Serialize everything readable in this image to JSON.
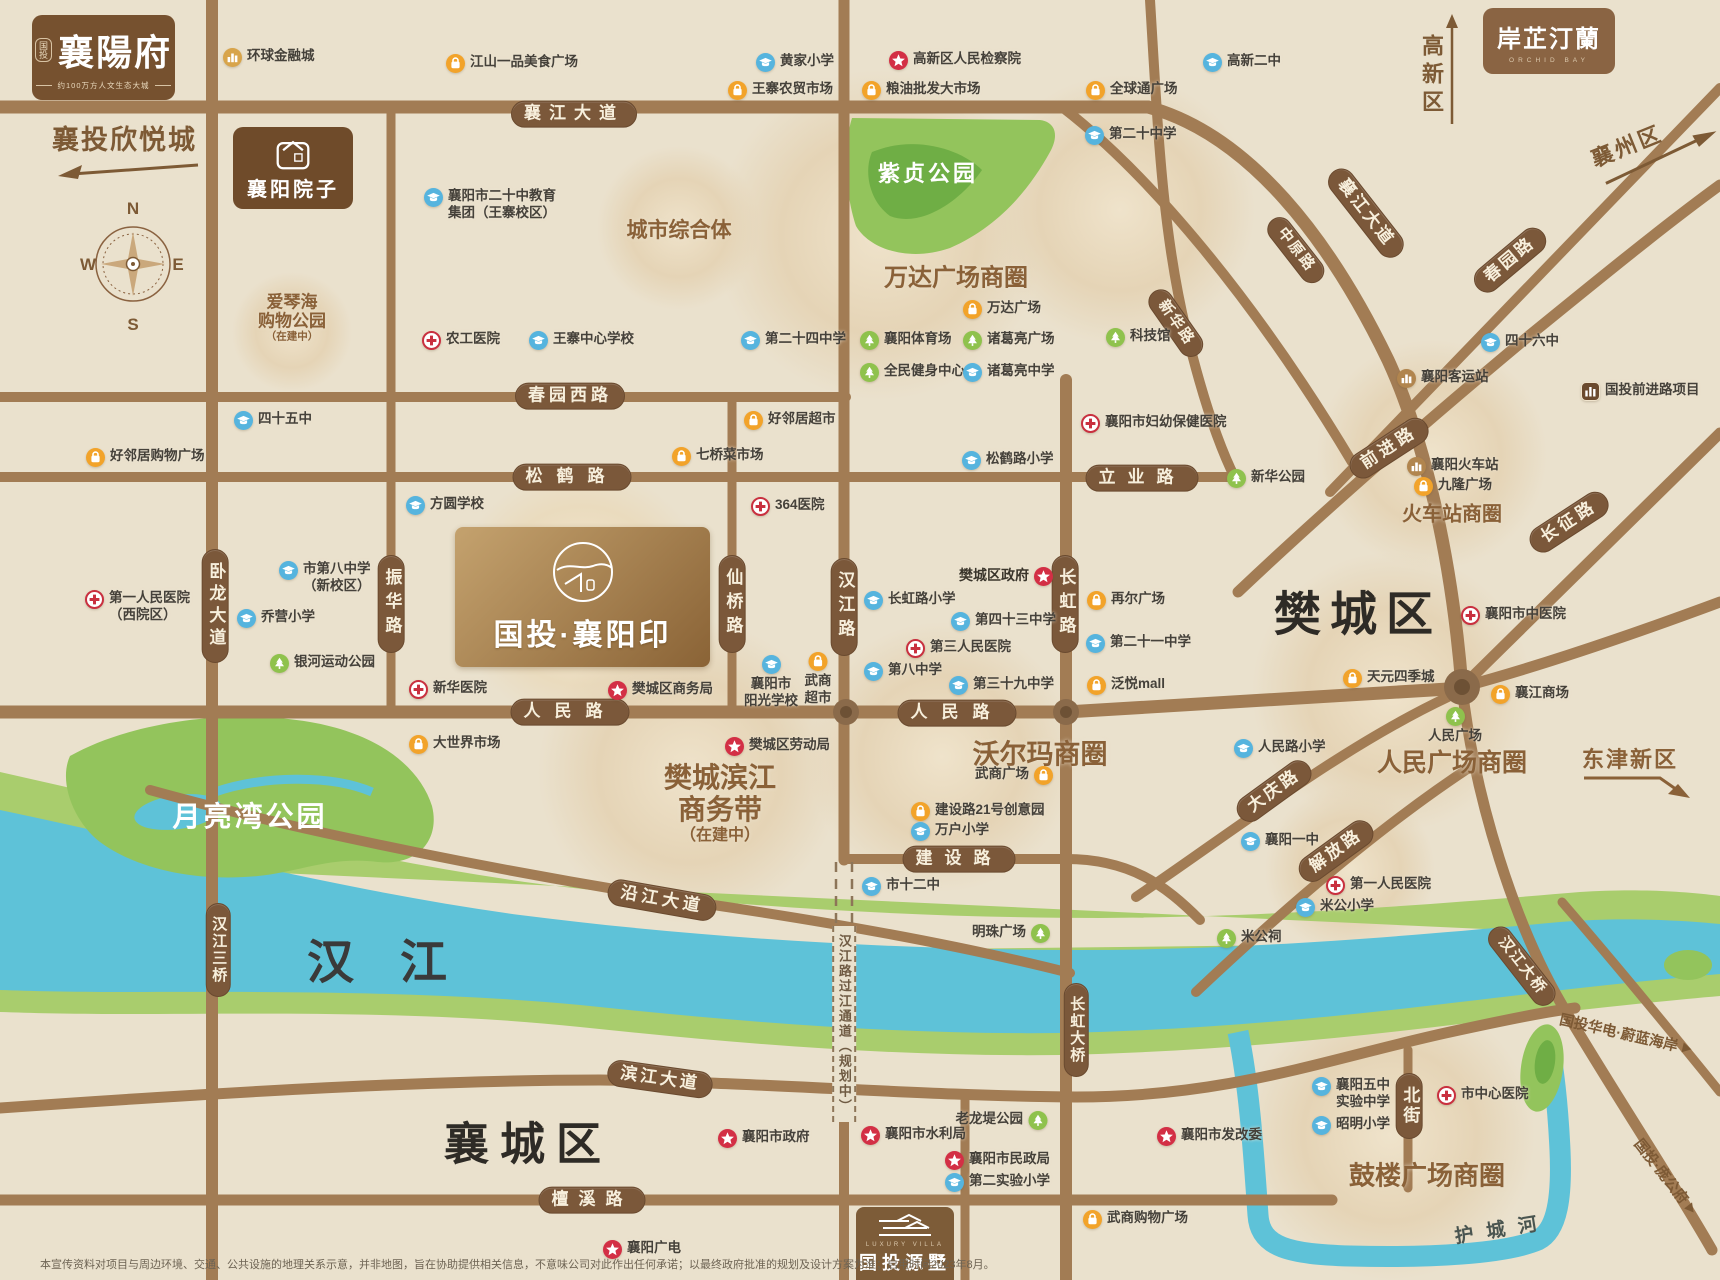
{
  "title": "国投·襄阳印 区位示意图",
  "colors": {
    "background": "#eae1cd",
    "road": "#a27c54",
    "pill": "#7b583a",
    "river": "#5ec2d8",
    "bank_green": "#a9cd6d",
    "park_green": "#93c45c",
    "accent_brown": "#8a6138",
    "school_blue": "#56b4de",
    "hospital_red": "#c9303f",
    "gov_red": "#d32f45",
    "shop_orange": "#f2a32a",
    "park_icon_green": "#8fc24d",
    "station_brown": "#b1854e"
  },
  "compass": {
    "n": "N",
    "e": "E",
    "s": "S",
    "w": "W"
  },
  "logos": {
    "xiangyangfu": {
      "seal": "国投",
      "title": "襄陽府",
      "tagline": "约100万方人文生态大城"
    },
    "xinyuecheng": {
      "title": "襄投欣悦城"
    },
    "yard": {
      "title": "襄阳院子"
    },
    "orchid": {
      "title": "岸芷汀蘭",
      "subtitle": "ORCHID BAY"
    },
    "yinpin": {
      "title": "国投·襄阳印"
    },
    "yuanshu": {
      "en": "LUXURY VILLA",
      "title": "国投源墅"
    }
  },
  "arrows": {
    "xiangzhou": "襄州区",
    "gaoxinqu": "高新区",
    "dongjin": "东津新区",
    "weilan": "国投华电·蔚蓝海岸",
    "panggong": "国投·庞公府"
  },
  "water_labels": {
    "hanjiang": "汉江",
    "hucheng": "护城河"
  },
  "districts": {
    "fancheng": "樊城区",
    "xiangcheng": "襄城区"
  },
  "parks": {
    "yueliangwan": "月亮湾公园",
    "zizhen": "紫贞公园"
  },
  "area_labels": [
    {
      "text": "城市综合体",
      "x": 679,
      "y": 229,
      "size": 21
    },
    {
      "text": "万达广场商圈",
      "x": 956,
      "y": 275,
      "size": 24
    },
    {
      "text": "火车站商圈",
      "x": 1452,
      "y": 512,
      "size": 20
    },
    {
      "text": "沃尔玛商圈",
      "x": 1040,
      "y": 752,
      "size": 27
    },
    {
      "text": "人民广场商圈",
      "x": 1452,
      "y": 761,
      "size": 25
    },
    {
      "text": "鼓楼广场商圈",
      "x": 1427,
      "y": 1174,
      "size": 26
    },
    {
      "text": "樊城滨江",
      "x": 720,
      "y": 776,
      "size": 28
    },
    {
      "text": "商务带",
      "x": 720,
      "y": 808,
      "size": 28
    },
    {
      "text": "（在建中）",
      "x": 720,
      "y": 833,
      "size": 16
    },
    {
      "text": "爱琴海",
      "x": 292,
      "y": 300,
      "size": 17
    },
    {
      "text": "购物公园",
      "x": 292,
      "y": 319,
      "size": 17
    },
    {
      "text": "（在建中）",
      "x": 292,
      "y": 336,
      "size": 10.5
    }
  ],
  "road_pills": [
    {
      "text": "襄江大道",
      "x": 574,
      "y": 114,
      "ls": 8
    },
    {
      "text": "春园西路",
      "x": 570,
      "y": 396,
      "ls": 4
    },
    {
      "text": "松鹤路",
      "x": 572,
      "y": 477,
      "ls": 14
    },
    {
      "text": "立业路",
      "x": 1142,
      "y": 478,
      "ls": 12
    },
    {
      "text": "人民路",
      "x": 570,
      "y": 712,
      "ls": 14
    },
    {
      "text": "人民路",
      "x": 957,
      "y": 713,
      "ls": 14
    },
    {
      "text": "建设路",
      "x": 959,
      "y": 859,
      "ls": 12
    },
    {
      "text": "沿江大道",
      "x": 662,
      "y": 900,
      "rot": 10,
      "ls": 4
    },
    {
      "text": "滨江大道",
      "x": 660,
      "y": 1079,
      "rot": 8,
      "ls": 3
    },
    {
      "text": "檀溪路",
      "x": 592,
      "y": 1200,
      "ls": 10
    },
    {
      "text": "卧龙大道",
      "x": 215,
      "y": 606,
      "v": 1,
      "ls": 5
    },
    {
      "text": "振华路",
      "x": 391,
      "y": 604,
      "v": 1,
      "ls": 7
    },
    {
      "text": "仙桥路",
      "x": 732,
      "y": 604,
      "v": 1,
      "ls": 7
    },
    {
      "text": "汉江路",
      "x": 844,
      "y": 607,
      "v": 1,
      "ls": 7
    },
    {
      "text": "长虹路",
      "x": 1065,
      "y": 604,
      "v": 1,
      "ls": 7
    },
    {
      "text": "汉江三桥",
      "x": 218,
      "y": 950,
      "v": 1,
      "ls": 2,
      "fs": 15
    },
    {
      "text": "长虹大桥",
      "x": 1076,
      "y": 1030,
      "v": 1,
      "ls": 2,
      "fs": 15
    },
    {
      "text": "北街",
      "x": 1409,
      "y": 1106,
      "v": 1,
      "ls": 3
    },
    {
      "text": "襄江大道",
      "x": 1366,
      "y": 213,
      "rot": 52,
      "ls": 3
    },
    {
      "text": "中原路",
      "x": 1296,
      "y": 250,
      "rot": 52,
      "ls": 2,
      "fs": 15
    },
    {
      "text": "新华路",
      "x": 1176,
      "y": 323,
      "rot": 55,
      "ls": 2,
      "fs": 15
    },
    {
      "text": "春园路",
      "x": 1510,
      "y": 260,
      "rot": -40,
      "ls": 3
    },
    {
      "text": "前进路",
      "x": 1389,
      "y": 448,
      "rot": -33,
      "ls": 4
    },
    {
      "text": "长征路",
      "x": 1569,
      "y": 522,
      "rot": -33,
      "ls": 4
    },
    {
      "text": "大庆路",
      "x": 1274,
      "y": 791,
      "rot": -36,
      "ls": 3
    },
    {
      "text": "解放路",
      "x": 1336,
      "y": 851,
      "rot": -36,
      "ls": 3
    },
    {
      "text": "汉江大桥",
      "x": 1522,
      "y": 966,
      "rot": 52,
      "ls": 2,
      "fs": 15
    }
  ],
  "planned_road": {
    "text": "汉江路过江通道（规划中）",
    "x": 844,
    "y": 1024
  },
  "pois": [
    {
      "t": "landmark",
      "x": 232,
      "y": 57,
      "s": "环球金融城"
    },
    {
      "t": "shop",
      "x": 455,
      "y": 63,
      "s": "江山一品美食广场"
    },
    {
      "t": "school",
      "x": 765,
      "y": 62,
      "s": "黄家小学"
    },
    {
      "t": "shop",
      "x": 737,
      "y": 90,
      "s": "王寨农贸市场"
    },
    {
      "t": "gov",
      "x": 898,
      "y": 60,
      "s": "高新区人民检察院"
    },
    {
      "t": "shop",
      "x": 871,
      "y": 90,
      "s": "粮油批发大市场"
    },
    {
      "t": "shop",
      "x": 1095,
      "y": 90,
      "s": "全球通广场"
    },
    {
      "t": "school",
      "x": 1212,
      "y": 62,
      "s": "高新二中"
    },
    {
      "t": "school",
      "x": 1094,
      "y": 135,
      "s": "第二十中学"
    },
    {
      "t": "school",
      "x": 433,
      "y": 197,
      "s": "襄阳市二十中教育",
      "s2": "集团（王寨校区）"
    },
    {
      "t": "hospital",
      "x": 431,
      "y": 340,
      "s": "农工医院"
    },
    {
      "t": "school",
      "x": 538,
      "y": 340,
      "s": "王寨中心学校"
    },
    {
      "t": "school",
      "x": 750,
      "y": 340,
      "s": "第二十四中学"
    },
    {
      "t": "park",
      "x": 869,
      "y": 340,
      "s": "襄阳体育场"
    },
    {
      "t": "park",
      "x": 972,
      "y": 340,
      "s": "诸葛亮广场"
    },
    {
      "t": "park",
      "x": 869,
      "y": 372,
      "s": "全民健身中心"
    },
    {
      "t": "school",
      "x": 972,
      "y": 372,
      "s": "诸葛亮中学"
    },
    {
      "t": "shop",
      "x": 972,
      "y": 309,
      "s": "万达广场"
    },
    {
      "t": "park",
      "x": 1115,
      "y": 337,
      "s": "科技馆"
    },
    {
      "t": "school",
      "x": 243,
      "y": 420,
      "s": "四十五中"
    },
    {
      "t": "shop",
      "x": 95,
      "y": 457,
      "s": "好邻居购物广场"
    },
    {
      "t": "shop",
      "x": 753,
      "y": 420,
      "s": "好邻居超市"
    },
    {
      "t": "shop",
      "x": 681,
      "y": 456,
      "s": "七桥菜市场"
    },
    {
      "t": "school",
      "x": 415,
      "y": 505,
      "s": "方圆学校"
    },
    {
      "t": "hospital",
      "x": 760,
      "y": 506,
      "s": "364医院"
    },
    {
      "t": "school",
      "x": 971,
      "y": 460,
      "s": "松鹤路小学"
    },
    {
      "t": "hospital",
      "x": 1090,
      "y": 423,
      "s": "襄阳市妇幼保健医院"
    },
    {
      "t": "park",
      "x": 1236,
      "y": 478,
      "s": "新华公园"
    },
    {
      "t": "hospital",
      "x": 418,
      "y": 689,
      "s": "新华医院"
    },
    {
      "t": "shop",
      "x": 418,
      "y": 744,
      "s": "大世界市场"
    },
    {
      "t": "school",
      "x": 288,
      "y": 570,
      "s": "市第八中学",
      "s2": "（新校区）"
    },
    {
      "t": "school",
      "x": 246,
      "y": 618,
      "s": "乔营小学"
    },
    {
      "t": "hospital",
      "x": 94,
      "y": 599,
      "s": "第一人民医院",
      "s2": "（西院区）"
    },
    {
      "t": "park",
      "x": 279,
      "y": 663,
      "s": "银河运动公园"
    },
    {
      "t": "gov",
      "x": 617,
      "y": 690,
      "s": "樊城区商务局"
    },
    {
      "t": "school",
      "x": 771,
      "y": 664,
      "s": "襄阳市",
      "s2": "阳光学校",
      "top": 1
    },
    {
      "t": "shop",
      "x": 818,
      "y": 661,
      "s": "武商",
      "s2": "超市",
      "top": 1
    },
    {
      "t": "gov",
      "x": 1043,
      "y": 576,
      "s": "樊城区政府",
      "side": "left",
      "bold": 1
    },
    {
      "t": "school",
      "x": 873,
      "y": 600,
      "s": "长虹路小学"
    },
    {
      "t": "shop",
      "x": 1096,
      "y": 600,
      "s": "再尔广场"
    },
    {
      "t": "school",
      "x": 960,
      "y": 621,
      "s": "第四十三中学"
    },
    {
      "t": "hospital",
      "x": 915,
      "y": 648,
      "s": "第三人民医院"
    },
    {
      "t": "school",
      "x": 873,
      "y": 671,
      "s": "第八中学"
    },
    {
      "t": "school",
      "x": 958,
      "y": 685,
      "s": "第三十九中学"
    },
    {
      "t": "school",
      "x": 1095,
      "y": 643,
      "s": "第二十一中学"
    },
    {
      "t": "shop",
      "x": 1096,
      "y": 685,
      "s": "泛悦mall"
    },
    {
      "t": "shop",
      "x": 1043,
      "y": 775,
      "s": "武商广场",
      "side": "left"
    },
    {
      "t": "shop",
      "x": 920,
      "y": 811,
      "s": "建设路21号创意园"
    },
    {
      "t": "school",
      "x": 920,
      "y": 831,
      "s": "万户小学"
    },
    {
      "t": "school",
      "x": 871,
      "y": 886,
      "s": "市十二中"
    },
    {
      "t": "park",
      "x": 1040,
      "y": 933,
      "s": "明珠广场",
      "side": "left"
    },
    {
      "t": "gov",
      "x": 734,
      "y": 746,
      "s": "樊城区劳动局"
    },
    {
      "t": "station",
      "x": 1406,
      "y": 378,
      "s": "襄阳客运站"
    },
    {
      "t": "school",
      "x": 1490,
      "y": 342,
      "s": "四十六中"
    },
    {
      "t": "project",
      "x": 1590,
      "y": 391,
      "s": "国投前进路项目"
    },
    {
      "t": "station",
      "x": 1416,
      "y": 466,
      "s": "襄阳火车站"
    },
    {
      "t": "shop",
      "x": 1423,
      "y": 486,
      "s": "九隆广场"
    },
    {
      "t": "hospital",
      "x": 1470,
      "y": 615,
      "s": "襄阳市中医院"
    },
    {
      "t": "shop",
      "x": 1352,
      "y": 678,
      "s": "天元四季城"
    },
    {
      "t": "shop",
      "x": 1500,
      "y": 694,
      "s": "襄江商场"
    },
    {
      "t": "park",
      "x": 1455,
      "y": 716,
      "s": "人民广场",
      "top": 1
    },
    {
      "t": "school",
      "x": 1243,
      "y": 748,
      "s": "人民路小学"
    },
    {
      "t": "school",
      "x": 1250,
      "y": 841,
      "s": "襄阳一中"
    },
    {
      "t": "hospital",
      "x": 1335,
      "y": 885,
      "s": "第一人民医院"
    },
    {
      "t": "school",
      "x": 1305,
      "y": 907,
      "s": "米公小学"
    },
    {
      "t": "park",
      "x": 1226,
      "y": 938,
      "s": "米公祠"
    },
    {
      "t": "school",
      "x": 1321,
      "y": 1086,
      "s": "襄阳五中",
      "s2": "实验中学"
    },
    {
      "t": "school",
      "x": 1321,
      "y": 1125,
      "s": "昭明小学"
    },
    {
      "t": "hospital",
      "x": 1446,
      "y": 1095,
      "s": "市中心医院"
    },
    {
      "t": "gov",
      "x": 1166,
      "y": 1136,
      "s": "襄阳市发改委"
    },
    {
      "t": "park",
      "x": 1037,
      "y": 1120,
      "s": "老龙堤公园",
      "side": "left"
    },
    {
      "t": "gov",
      "x": 727,
      "y": 1138,
      "s": "襄阳市政府"
    },
    {
      "t": "gov",
      "x": 870,
      "y": 1135,
      "s": "襄阳市水利局"
    },
    {
      "t": "gov",
      "x": 954,
      "y": 1160,
      "s": "襄阳市民政局"
    },
    {
      "t": "school",
      "x": 954,
      "y": 1182,
      "s": "第二实验小学"
    },
    {
      "t": "shop",
      "x": 1092,
      "y": 1219,
      "s": "武商购物广场"
    },
    {
      "t": "gov",
      "x": 612,
      "y": 1249,
      "s": "襄阳广电"
    }
  ],
  "disclaimer": "本宣传资料对项目与周边环境、交通、公共设施的地理关系示意，并非地图，旨在协助提供相关信息，不意味公司对此作出任何承诺；以最终政府批准的规划及设计方案为准；启用时间2023年8月。"
}
